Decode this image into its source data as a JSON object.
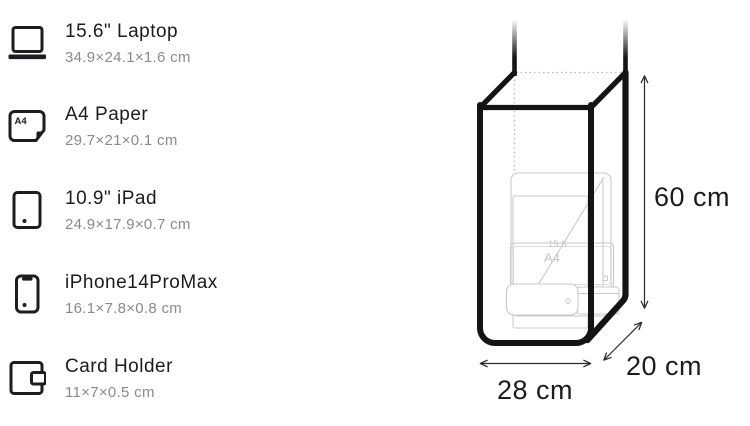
{
  "items": [
    {
      "icon": "laptop-icon",
      "name": "15.6\" Laptop",
      "dimensions": "34.9×24.1×1.6 cm"
    },
    {
      "icon": "a4-paper-icon",
      "name": "A4 Paper",
      "dimensions": "29.7×21×0.1 cm",
      "icon_label": "A4"
    },
    {
      "icon": "ipad-icon",
      "name": "10.9\" iPad",
      "dimensions": "24.9×17.9×0.7 cm"
    },
    {
      "icon": "iphone-icon",
      "name": "iPhone14ProMax",
      "dimensions": "16.1×7.8×0.8 cm"
    },
    {
      "icon": "card-holder-icon",
      "name": "Card Holder",
      "dimensions": "11×7×0.5 cm"
    }
  ],
  "diagram": {
    "height_label": "60 cm",
    "width_label": "28 cm",
    "depth_label": "20 cm",
    "contents_labels": {
      "laptop": "15.6",
      "paper": "A4"
    }
  },
  "colors": {
    "title": "#1c1c1e",
    "subtitle": "#8a8a8e",
    "bag_outline": "#141414",
    "faint_outline": "#c9c9c9",
    "arrow": "#2b2b2b"
  }
}
